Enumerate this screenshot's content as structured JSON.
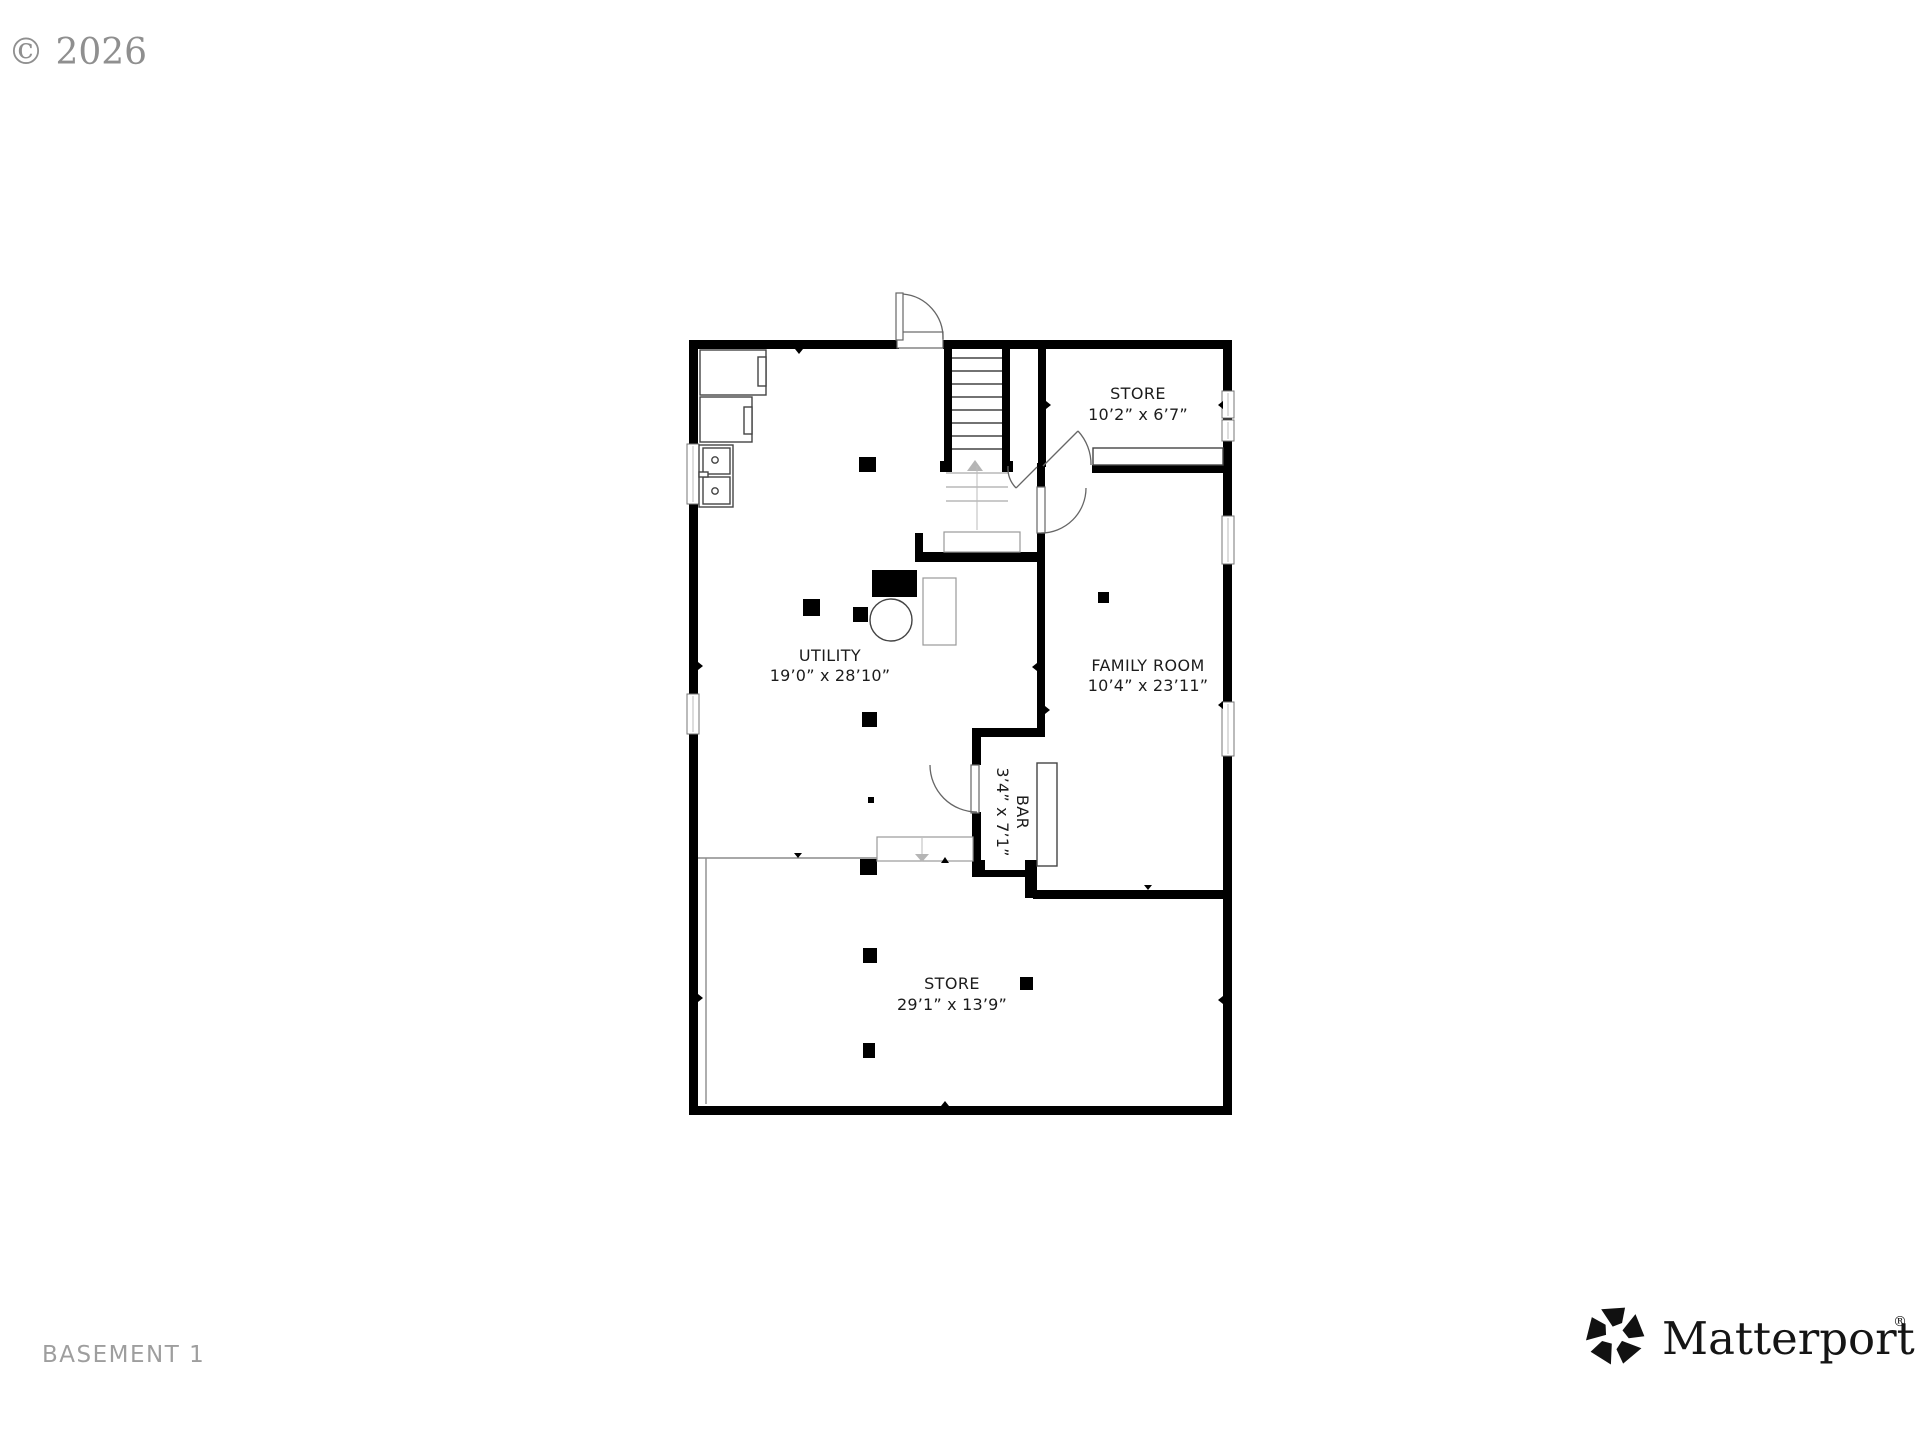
{
  "watermark": "© 2026",
  "floor_label": "BASEMENT 1",
  "brand": {
    "name": "Matterport",
    "registered": "®"
  },
  "rooms": [
    {
      "id": "store-upper",
      "name": "STORE",
      "dims": "10’2” x 6’7”"
    },
    {
      "id": "utility",
      "name": "UTILITY",
      "dims": "19’0” x 28’10”"
    },
    {
      "id": "family-room",
      "name": "FAMILY ROOM",
      "dims": "10’4” x 23’11”"
    },
    {
      "id": "bar",
      "name": "BAR",
      "dims": "3’4” x 7’1”"
    },
    {
      "id": "store-lower",
      "name": "STORE",
      "dims": "29’1” x 13’9”"
    }
  ],
  "colors": {
    "background": "#ffffff",
    "wall": "#000000",
    "room_label": "#1c1c1c",
    "watermark": "#8f8f8f",
    "floor_label": "#9e9e9e",
    "brand": "#151515",
    "window_frame": "#777777",
    "divider_line": "#8c8c8c"
  }
}
